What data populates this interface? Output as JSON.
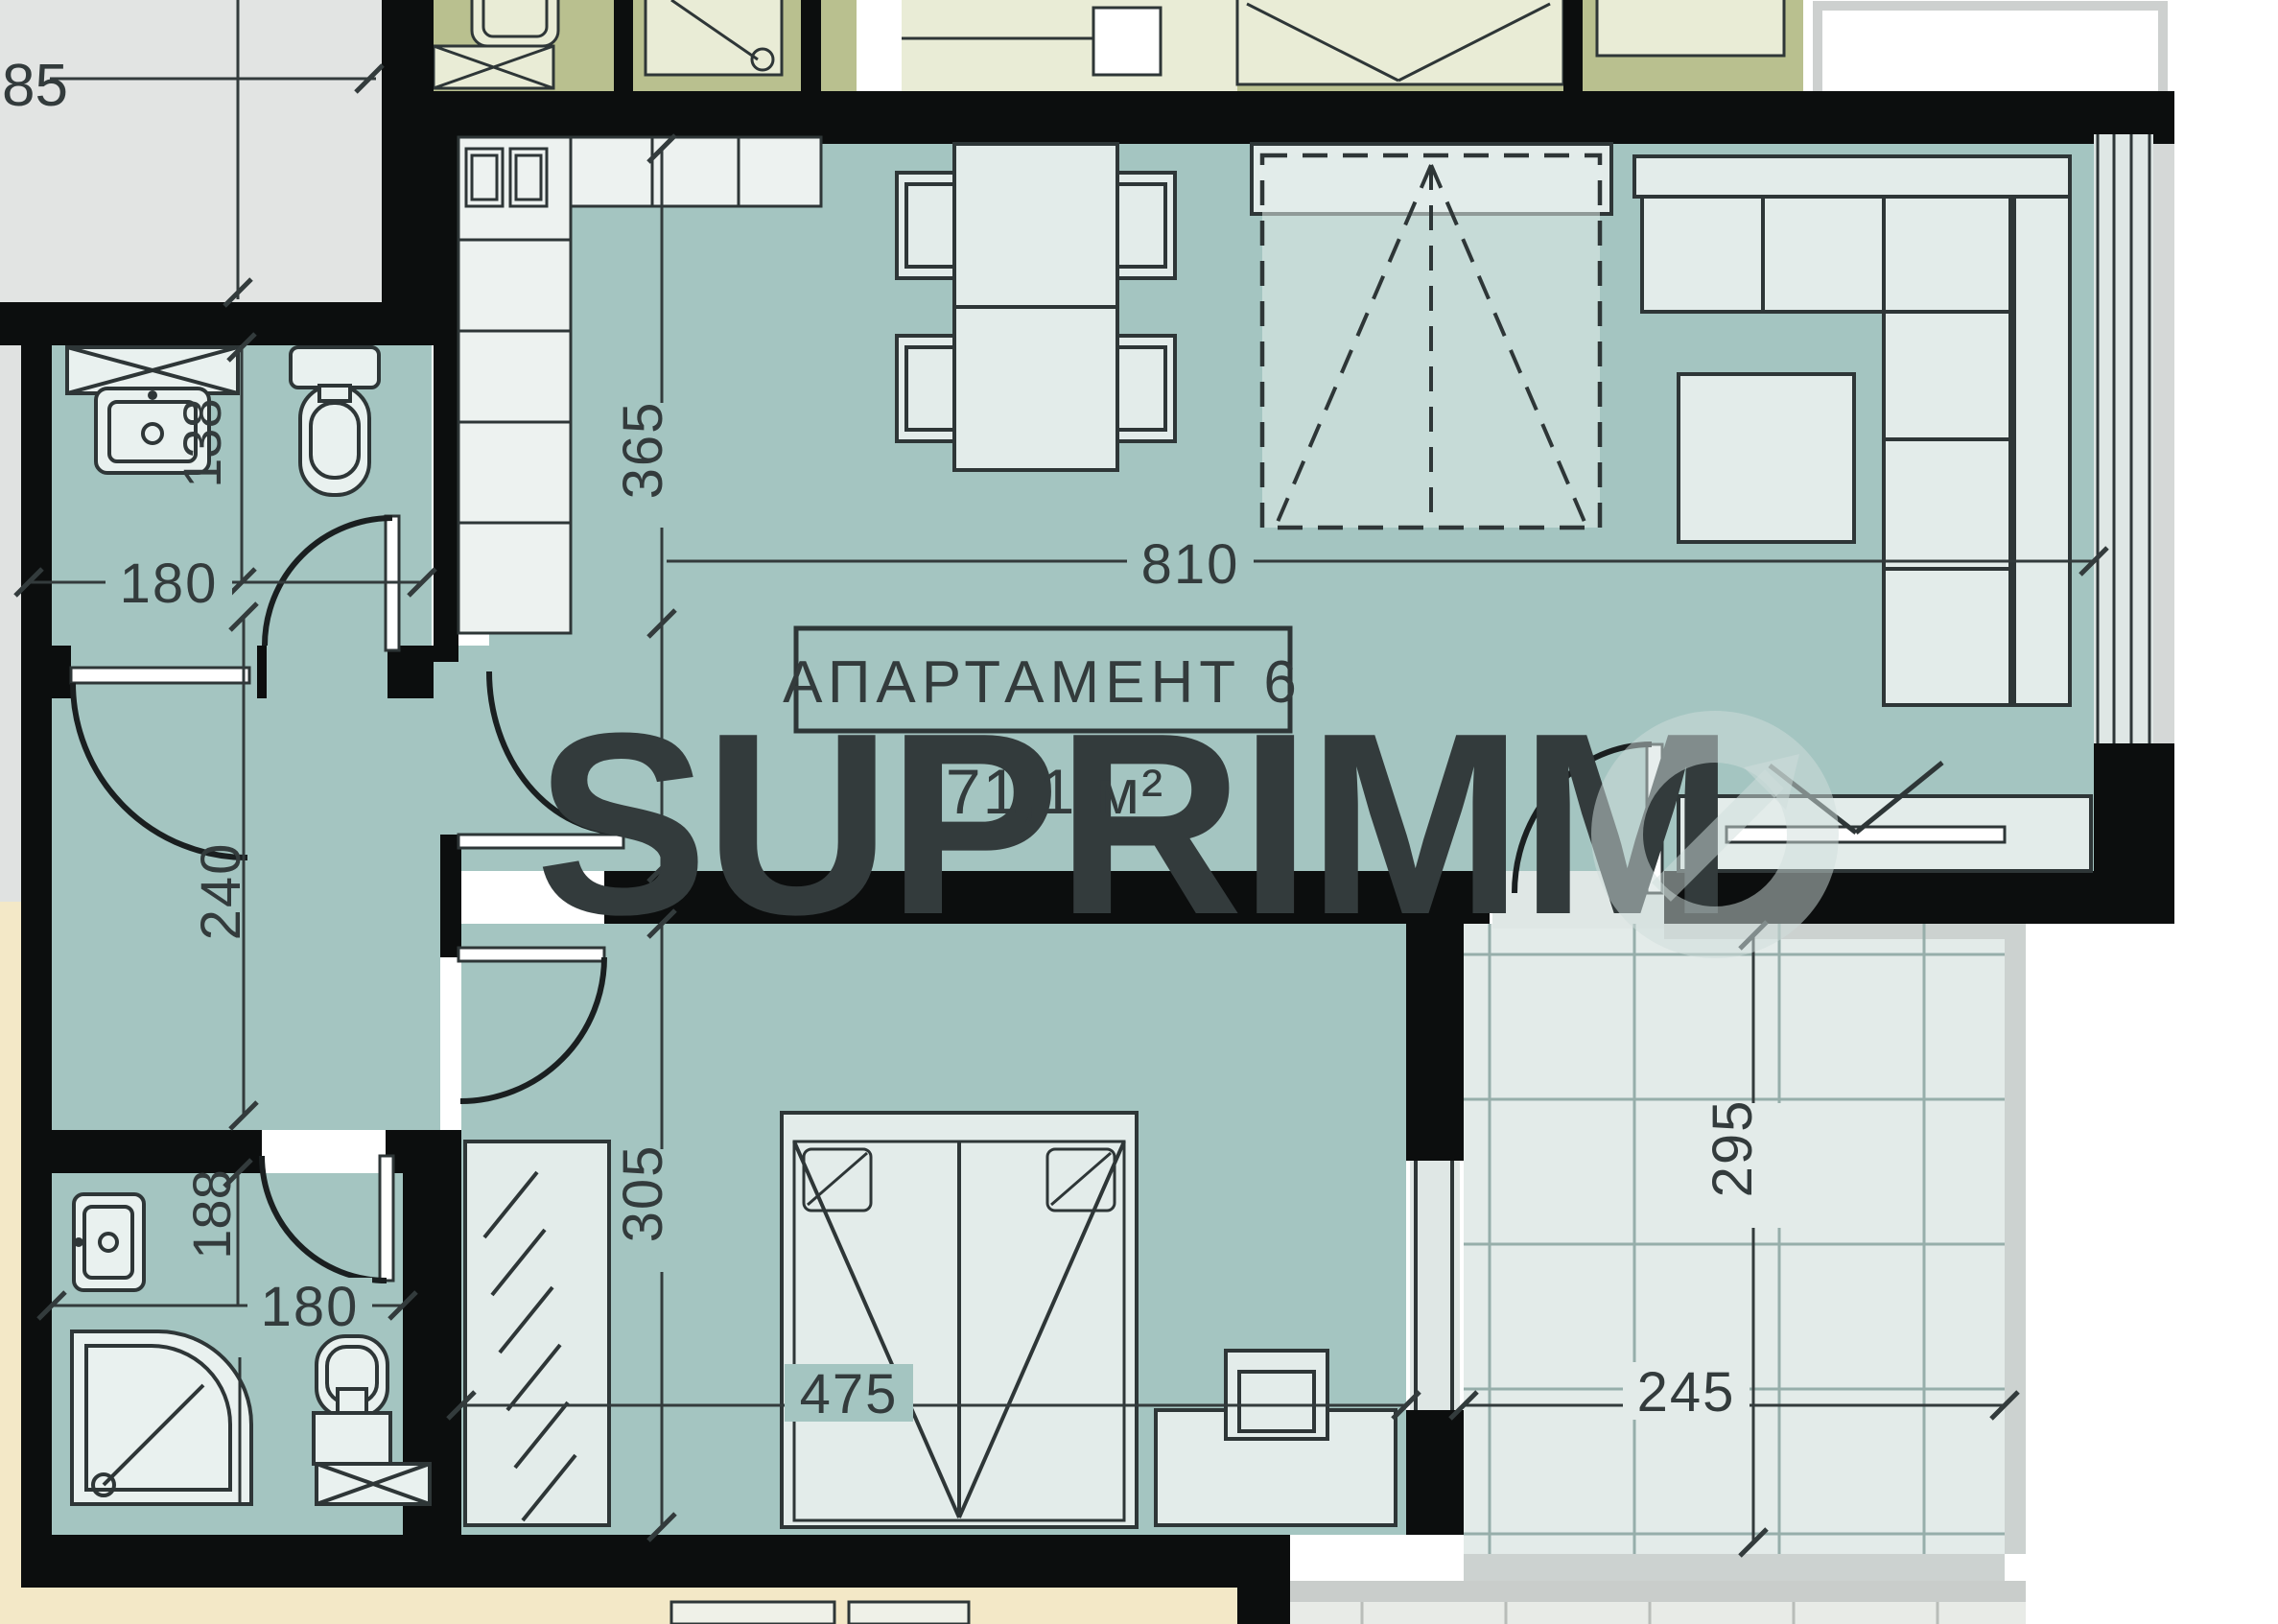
{
  "plan": {
    "apartment_label": "АПАРТАМЕНТ 6",
    "area_label": "71,1 м²",
    "watermark": {
      "text": "SUPRIMM",
      "logo_icon": "arrow-circle-o"
    },
    "dimensions": {
      "d85": "85",
      "d365": "365",
      "d810": "810",
      "d138": "138",
      "d180_top": "180",
      "d240": "240",
      "d188": "188",
      "d180_bottom": "180",
      "d305": "305",
      "d475": "475",
      "d245": "245",
      "d295": "295"
    },
    "colors": {
      "floor_teal": "#a4c5c1",
      "wall_black": "#0c0e0e",
      "furniture_light": "#e3ecea",
      "common_gray": "#e2e4e3",
      "neighbor_olive": "#b9c08f",
      "neighbor_beige": "#f3e8c7",
      "tile": "#e3ebe9",
      "tile_line": "#96aeaa",
      "line_dark": "#2e3637"
    }
  }
}
